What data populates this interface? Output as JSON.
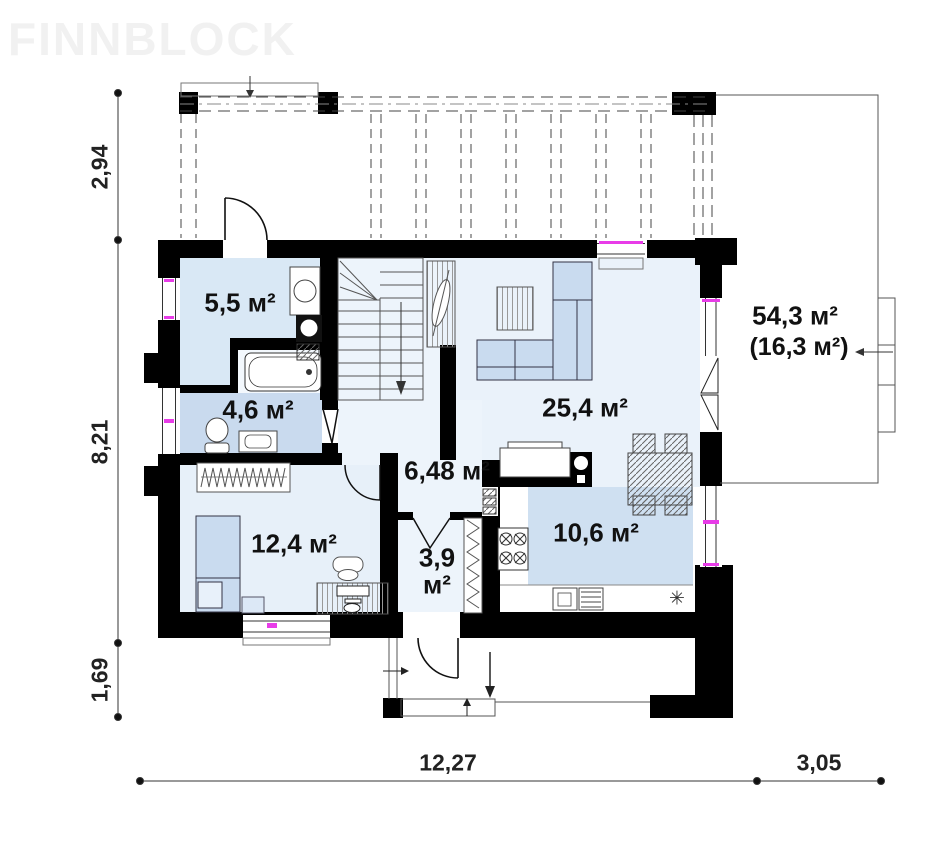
{
  "watermark": {
    "text": "FINNBLOCK"
  },
  "rooms": {
    "tech_room": {
      "area": "5,5 м²"
    },
    "bathroom": {
      "area": "4,6 м²"
    },
    "living_room": {
      "area": "25,4 м²"
    },
    "hallway": {
      "area": "6,48 м²"
    },
    "bedroom": {
      "area": "12,4 м²"
    },
    "vestibule": {
      "area": "3,9 м²"
    },
    "kitchen": {
      "area": "10,6 м²"
    },
    "terrace": {
      "area": "54,3 м²",
      "area_note": "(16,3 м²)"
    }
  },
  "dimensions": {
    "left": {
      "top": "2,94",
      "middle": "8,21",
      "bottom": "1,69"
    },
    "bottom": {
      "house": "12,27",
      "terrace": "3,05"
    }
  },
  "icons": {
    "fridge_snowflake": "✳"
  },
  "colors": {
    "wall": "#000000",
    "window_accent": "#e83ce8",
    "floor_light": "#edf4fb",
    "floor_living": "#eaf2fa",
    "floor_tech": "#d9e8f5",
    "floor_bath": "#c9daee",
    "floor_kitchen": "#cfe0f1",
    "floor_bedroom": "#e7f0f9",
    "furniture_blue": "#c9dbef"
  }
}
